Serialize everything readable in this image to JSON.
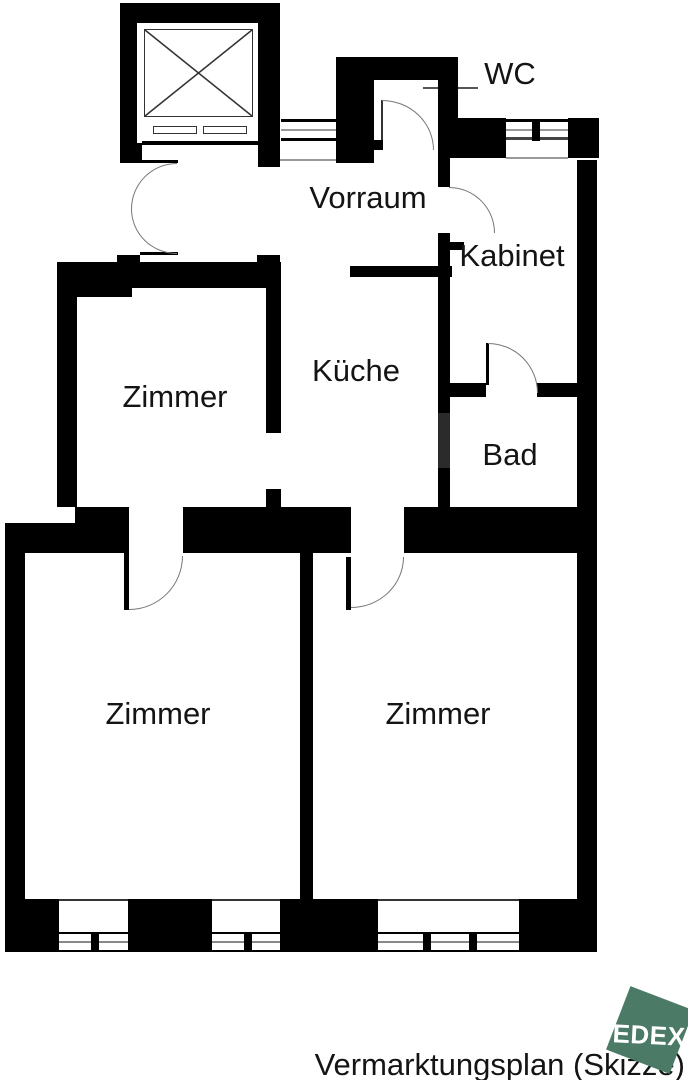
{
  "title": "Vermarktungsplan (Skizze)",
  "rooms": {
    "wc": "WC",
    "vorraum": "Vorraum",
    "kabinet": "Kabinet",
    "kueche": "Küche",
    "bad": "Bad",
    "zimmer_top": "Zimmer",
    "zimmer_bottom_left": "Zimmer",
    "zimmer_bottom_right": "Zimmer"
  },
  "logo": {
    "text": "EDEX",
    "color": "#4b7a66",
    "text_color": "#ffffff"
  },
  "colors": {
    "wall": "#000000",
    "background": "#ffffff",
    "door_arc": "#777777",
    "thin_line": "#333333",
    "shaft_segment": "#2b2b2b"
  },
  "geometry": {
    "walls": [
      [
        120,
        3,
        157,
        20
      ],
      [
        120,
        3,
        17,
        160
      ],
      [
        258,
        3,
        22,
        164
      ],
      [
        120,
        143,
        22,
        20
      ],
      [
        257,
        255,
        23,
        33
      ],
      [
        117,
        255,
        23,
        8
      ],
      [
        336,
        57,
        122,
        23
      ],
      [
        336,
        57,
        38,
        106
      ],
      [
        374,
        140,
        9,
        10
      ],
      [
        438,
        57,
        20,
        63
      ],
      [
        438,
        118,
        68,
        40
      ],
      [
        568,
        118,
        31,
        40
      ],
      [
        577,
        160,
        20,
        792
      ],
      [
        57,
        262,
        224,
        26
      ],
      [
        72,
        282,
        60,
        15
      ],
      [
        57,
        262,
        20,
        245
      ],
      [
        266,
        288,
        15,
        145
      ],
      [
        266,
        489,
        15,
        19
      ],
      [
        350,
        266,
        102,
        11
      ],
      [
        438,
        150,
        12,
        37
      ],
      [
        438,
        233,
        12,
        180
      ],
      [
        438,
        413,
        12,
        55,
        "#2b2b2b"
      ],
      [
        438,
        468,
        12,
        40
      ],
      [
        448,
        242,
        16,
        8
      ],
      [
        447,
        383,
        39,
        14
      ],
      [
        537,
        383,
        40,
        14
      ],
      [
        486,
        343,
        3,
        42
      ],
      [
        5,
        523,
        70,
        30
      ],
      [
        75,
        507,
        54,
        46
      ],
      [
        183,
        507,
        168,
        46
      ],
      [
        404,
        507,
        193,
        46
      ],
      [
        5,
        523,
        20,
        429
      ],
      [
        300,
        553,
        13,
        346
      ],
      [
        124,
        553,
        5,
        57
      ],
      [
        346,
        557,
        5,
        53
      ],
      [
        5,
        899,
        54,
        53
      ],
      [
        128,
        899,
        84,
        53
      ],
      [
        280,
        899,
        98,
        53
      ],
      [
        519,
        899,
        78,
        53
      ],
      [
        91,
        932,
        8,
        20
      ],
      [
        244,
        932,
        8,
        20
      ],
      [
        423,
        932,
        8,
        20
      ],
      [
        469,
        932,
        8,
        20
      ],
      [
        532,
        119,
        8,
        22
      ]
    ],
    "lines": [
      [
        142,
        141,
        116,
        4,
        "#000000"
      ],
      [
        140,
        160,
        38,
        3,
        "#000000"
      ],
      [
        140,
        252,
        38,
        3,
        "#000000"
      ],
      [
        423,
        87,
        55,
        2,
        "#555555"
      ],
      [
        281,
        119,
        59,
        3,
        "#000000"
      ],
      [
        281,
        129,
        59,
        2,
        "#999999"
      ],
      [
        281,
        138,
        59,
        3,
        "#000000"
      ],
      [
        278,
        159,
        62,
        2,
        "#999999"
      ],
      [
        506,
        119,
        62,
        3,
        "#000000"
      ],
      [
        506,
        129,
        62,
        2,
        "#999999"
      ],
      [
        506,
        137,
        62,
        3,
        "#444444"
      ],
      [
        506,
        157,
        62,
        2,
        "#999999"
      ],
      [
        381,
        100,
        2,
        50,
        "#333333"
      ],
      [
        59,
        899,
        69,
        2,
        "#333333"
      ],
      [
        212,
        899,
        68,
        2,
        "#333333"
      ],
      [
        378,
        899,
        142,
        2,
        "#333333"
      ],
      [
        59,
        932,
        69,
        2,
        "#000000"
      ],
      [
        59,
        941,
        69,
        2,
        "#888888"
      ],
      [
        59,
        950,
        69,
        2,
        "#000000"
      ],
      [
        212,
        932,
        68,
        2,
        "#000000"
      ],
      [
        212,
        941,
        68,
        2,
        "#888888"
      ],
      [
        212,
        950,
        68,
        2,
        "#000000"
      ],
      [
        378,
        932,
        142,
        2,
        "#000000"
      ],
      [
        378,
        941,
        142,
        2,
        "#888888"
      ],
      [
        378,
        950,
        142,
        2,
        "#000000"
      ]
    ],
    "boxes": [
      [
        144,
        29,
        109,
        88,
        1.5
      ],
      [
        153,
        126,
        44,
        8,
        1.2
      ],
      [
        203,
        126,
        44,
        8,
        1.2
      ]
    ],
    "arcs": [
      [
        131,
        163,
        46,
        46,
        "tl"
      ],
      [
        131,
        209,
        46,
        45,
        "bl"
      ],
      [
        382,
        100,
        52,
        50,
        "tr"
      ],
      [
        449,
        187,
        46,
        46,
        "tr"
      ],
      [
        488,
        343,
        50,
        50,
        "tr"
      ],
      [
        129,
        556,
        54,
        54,
        "br"
      ],
      [
        351,
        557,
        53,
        51,
        "br"
      ]
    ]
  }
}
